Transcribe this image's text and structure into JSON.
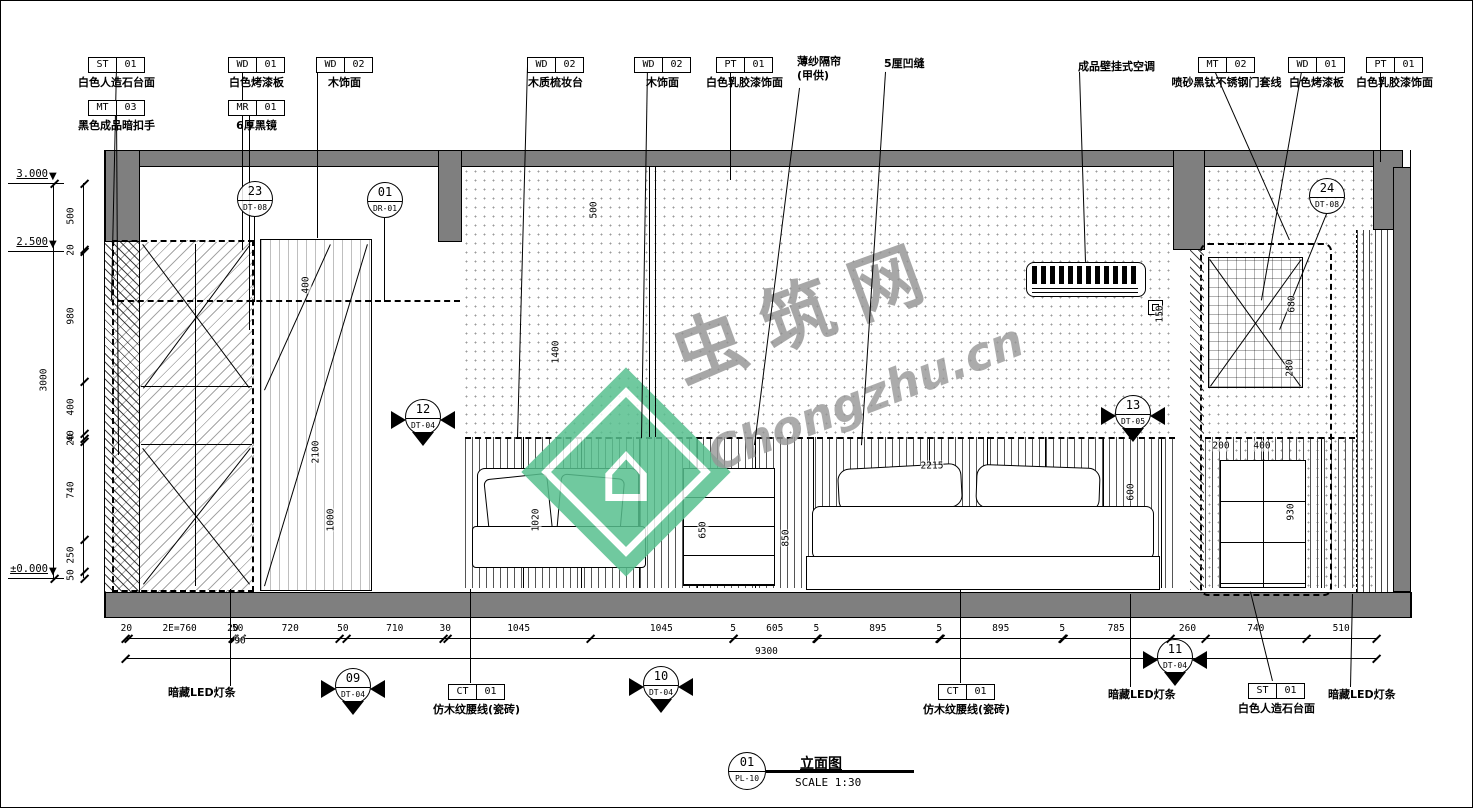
{
  "meta": {
    "sheet_no": "01",
    "sheet_code": "PL-10",
    "title": "立面图",
    "scale": "SCALE 1:30"
  },
  "watermark": {
    "site": "虫筑网",
    "url": "Chongzhu.cn",
    "green": "#58c08f",
    "gray": "#9b9b9b"
  },
  "colors": {
    "slab_gray": "#7f7f7f",
    "line": "#000000",
    "background": "#ffffff"
  },
  "levels": [
    {
      "label": "3.000",
      "y": 183
    },
    {
      "label": "2.500",
      "y": 251
    },
    {
      "label": "±0.000",
      "y": 578
    }
  ],
  "material_tags": [
    {
      "code": "ST",
      "num": "01",
      "label": "白色人造石台面",
      "x": 88,
      "y": 57
    },
    {
      "code": "MT",
      "num": "03",
      "label": "黑色成品暗扣手",
      "x": 88,
      "y": 100
    },
    {
      "code": "WD",
      "num": "01",
      "label": "白色烤漆板",
      "x": 228,
      "y": 57
    },
    {
      "code": "MR",
      "num": "01",
      "label": "6厚黑镜",
      "x": 228,
      "y": 100
    },
    {
      "code": "WD",
      "num": "02",
      "label": "木饰面",
      "x": 316,
      "y": 57
    },
    {
      "code": "WD",
      "num": "02",
      "label": "木质梳妆台",
      "x": 527,
      "y": 57
    },
    {
      "code": "WD",
      "num": "02",
      "label": "木饰面",
      "x": 634,
      "y": 57
    },
    {
      "code": "PT",
      "num": "01",
      "label": "白色乳胶漆饰面",
      "x": 716,
      "y": 57
    },
    {
      "code": "MT",
      "num": "02",
      "label": "喷砂黑钛不锈钢门套线",
      "x": 1198,
      "y": 57
    },
    {
      "code": "WD",
      "num": "01",
      "label": "白色烤漆板",
      "x": 1288,
      "y": 57
    },
    {
      "code": "PT",
      "num": "01",
      "label": "白色乳胶漆饰面",
      "x": 1366,
      "y": 57
    },
    {
      "code": "CT",
      "num": "01",
      "label": "仿木纹腰线(瓷砖)",
      "x": 448,
      "y": 684
    },
    {
      "code": "CT",
      "num": "01",
      "label": "仿木纹腰线(瓷砖)",
      "x": 938,
      "y": 684
    },
    {
      "code": "ST",
      "num": "01",
      "label": "白色人造石台面",
      "x": 1248,
      "y": 683
    }
  ],
  "annotations": [
    {
      "text": "薄纱隔帘\n(甲供)",
      "x": 797,
      "y": 55
    },
    {
      "text": "5厘凹缝",
      "x": 884,
      "y": 57
    },
    {
      "text": "成品壁挂式空调",
      "x": 1078,
      "y": 60
    },
    {
      "text": "暗藏LED灯条",
      "x": 168,
      "y": 686
    },
    {
      "text": "暗藏LED灯条",
      "x": 1108,
      "y": 688
    },
    {
      "text": "暗藏LED灯条",
      "x": 1328,
      "y": 688
    }
  ],
  "callouts": [
    {
      "num": "23",
      "code": "DT-08",
      "cx": 255,
      "cy": 199,
      "type": "plain"
    },
    {
      "num": "01",
      "code": "DR-01",
      "cx": 385,
      "cy": 200,
      "type": "plain"
    },
    {
      "num": "24",
      "code": "DT-08",
      "cx": 1327,
      "cy": 196,
      "type": "plain"
    },
    {
      "num": "12",
      "code": "DT-04",
      "cx": 423,
      "cy": 417,
      "type": "section"
    },
    {
      "num": "13",
      "code": "DT-05",
      "cx": 1133,
      "cy": 413,
      "type": "section"
    },
    {
      "num": "09",
      "code": "DT-04",
      "cx": 353,
      "cy": 686,
      "type": "section"
    },
    {
      "num": "10",
      "code": "DT-04",
      "cx": 661,
      "cy": 684,
      "type": "section"
    },
    {
      "num": "11",
      "code": "DT-04",
      "cx": 1175,
      "cy": 657,
      "type": "section"
    }
  ],
  "dims": {
    "left_chain": {
      "total": "3000",
      "segments": [
        "500",
        "20",
        "980",
        "400",
        "40",
        "20",
        "740",
        "250",
        "50"
      ]
    },
    "bottom_chain": {
      "total": "9300",
      "sub": "90",
      "segments": [
        "20",
        "2E=760",
        "20",
        "50",
        "720",
        "50",
        "710",
        "30",
        "1045",
        "1045",
        "5",
        "605",
        "5",
        "895",
        "5",
        "895",
        "5",
        "785",
        "260",
        "740",
        "510"
      ]
    },
    "inner": [
      {
        "v": "500",
        "x": 594,
        "y": 210,
        "o": "v"
      },
      {
        "v": "1400",
        "x": 556,
        "y": 352,
        "o": "v"
      },
      {
        "v": "400",
        "x": 306,
        "y": 285,
        "o": "v"
      },
      {
        "v": "2100",
        "x": 316,
        "y": 452,
        "o": "v"
      },
      {
        "v": "1000",
        "x": 331,
        "y": 520,
        "o": "v"
      },
      {
        "v": "1020",
        "x": 536,
        "y": 520,
        "o": "v"
      },
      {
        "v": "650",
        "x": 703,
        "y": 530,
        "o": "v"
      },
      {
        "v": "850",
        "x": 786,
        "y": 538,
        "o": "v"
      },
      {
        "v": "2215",
        "x": 932,
        "y": 466,
        "o": "h"
      },
      {
        "v": "600",
        "x": 1131,
        "y": 492,
        "o": "v"
      },
      {
        "v": "150",
        "x": 1160,
        "y": 314,
        "o": "v"
      },
      {
        "v": "680",
        "x": 1292,
        "y": 304,
        "o": "v"
      },
      {
        "v": "280",
        "x": 1290,
        "y": 368,
        "o": "v"
      },
      {
        "v": "200",
        "x": 1221,
        "y": 446,
        "o": "h"
      },
      {
        "v": "400",
        "x": 1262,
        "y": 446,
        "o": "h"
      },
      {
        "v": "930",
        "x": 1291,
        "y": 512,
        "o": "v"
      },
      {
        "v": "90",
        "x": 240,
        "y": 641,
        "o": "h"
      }
    ]
  },
  "geometry": {
    "lines": [
      [
        800,
        88,
        755,
        445
      ],
      [
        886,
        72,
        862,
        445
      ],
      [
        1080,
        72,
        1086,
        262
      ],
      [
        528,
        66,
        518,
        438
      ],
      [
        648,
        66,
        642,
        438
      ],
      [
        731,
        66,
        731,
        180
      ],
      [
        318,
        66,
        318,
        238
      ],
      [
        243,
        66,
        243,
        250
      ],
      [
        250,
        109,
        250,
        330
      ],
      [
        117,
        66,
        112,
        300
      ],
      [
        117,
        109,
        119,
        455
      ],
      [
        1213,
        66,
        1290,
        240
      ],
      [
        1303,
        66,
        1262,
        300
      ],
      [
        1381,
        66,
        1381,
        162
      ],
      [
        230,
        686,
        230,
        589
      ],
      [
        470,
        683,
        470,
        589
      ],
      [
        960,
        683,
        960,
        589
      ],
      [
        1130,
        687,
        1130,
        594
      ],
      [
        1272,
        681,
        1250,
        592
      ],
      [
        1350,
        687,
        1352,
        594
      ],
      [
        650,
        167,
        650,
        437
      ],
      [
        656,
        167,
        656,
        437
      ],
      [
        255,
        217,
        255,
        302
      ],
      [
        385,
        218,
        385,
        302
      ],
      [
        1327,
        214,
        1280,
        330
      ],
      [
        143,
        388,
        250,
        244
      ],
      [
        143,
        244,
        250,
        388
      ],
      [
        143,
        584,
        250,
        448
      ],
      [
        143,
        448,
        250,
        584
      ],
      [
        141,
        386,
        252,
        386
      ],
      [
        141,
        444,
        252,
        444
      ],
      [
        196,
        244,
        196,
        586
      ],
      [
        264,
        586,
        367,
        244
      ],
      [
        264,
        390,
        330,
        244
      ],
      [
        1210,
        386,
        1301,
        259
      ],
      [
        1210,
        259,
        1301,
        386
      ],
      [
        105,
        150,
        105,
        618
      ],
      [
        1411,
        150,
        1411,
        618
      ]
    ]
  }
}
